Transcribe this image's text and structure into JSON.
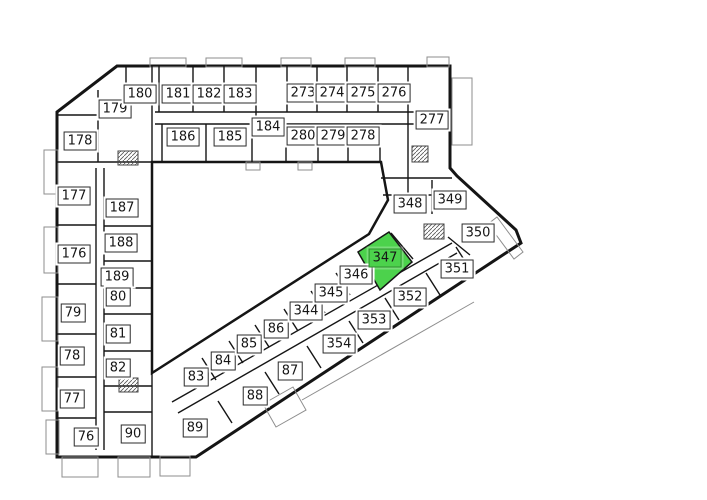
{
  "floorplan": {
    "selected_unit": "347",
    "highlight_fill": "#4cd24c",
    "highlight_border": "#2e8f2e",
    "wall_color": "#151515",
    "label_background": "#ffffff",
    "label_border": "#2b2b2b",
    "label_text_color": "#161616",
    "units": [
      {
        "number": "179",
        "x": 115,
        "y": 109,
        "highlighted": false
      },
      {
        "number": "180",
        "x": 140,
        "y": 94,
        "highlighted": false
      },
      {
        "number": "181",
        "x": 178,
        "y": 94,
        "highlighted": false
      },
      {
        "number": "182",
        "x": 209,
        "y": 94,
        "highlighted": false
      },
      {
        "number": "183",
        "x": 240,
        "y": 94,
        "highlighted": false
      },
      {
        "number": "178",
        "x": 80,
        "y": 141,
        "highlighted": false
      },
      {
        "number": "186",
        "x": 183,
        "y": 137,
        "highlighted": false
      },
      {
        "number": "185",
        "x": 230,
        "y": 137,
        "highlighted": false
      },
      {
        "number": "184",
        "x": 268,
        "y": 127,
        "highlighted": false
      },
      {
        "number": "187",
        "x": 122,
        "y": 208,
        "highlighted": false
      },
      {
        "number": "273",
        "x": 303,
        "y": 93,
        "highlighted": false
      },
      {
        "number": "274",
        "x": 332,
        "y": 93,
        "highlighted": false
      },
      {
        "number": "275",
        "x": 363,
        "y": 93,
        "highlighted": false
      },
      {
        "number": "276",
        "x": 394,
        "y": 93,
        "highlighted": false
      },
      {
        "number": "280",
        "x": 303,
        "y": 136,
        "highlighted": false
      },
      {
        "number": "279",
        "x": 333,
        "y": 136,
        "highlighted": false
      },
      {
        "number": "278",
        "x": 363,
        "y": 136,
        "highlighted": false
      },
      {
        "number": "277",
        "x": 432,
        "y": 120,
        "highlighted": false
      },
      {
        "number": "177",
        "x": 74,
        "y": 196,
        "highlighted": false
      },
      {
        "number": "176",
        "x": 74,
        "y": 254,
        "highlighted": false
      },
      {
        "number": "188",
        "x": 121,
        "y": 243,
        "highlighted": false
      },
      {
        "number": "189",
        "x": 117,
        "y": 277,
        "highlighted": false
      },
      {
        "number": "80",
        "x": 118,
        "y": 297,
        "highlighted": false
      },
      {
        "number": "79",
        "x": 73,
        "y": 313,
        "highlighted": false
      },
      {
        "number": "81",
        "x": 118,
        "y": 334,
        "highlighted": false
      },
      {
        "number": "78",
        "x": 72,
        "y": 356,
        "highlighted": false
      },
      {
        "number": "82",
        "x": 118,
        "y": 368,
        "highlighted": false
      },
      {
        "number": "77",
        "x": 72,
        "y": 399,
        "highlighted": false
      },
      {
        "number": "76",
        "x": 86,
        "y": 437,
        "highlighted": false
      },
      {
        "number": "90",
        "x": 133,
        "y": 434,
        "highlighted": false
      },
      {
        "number": "83",
        "x": 196,
        "y": 377,
        "highlighted": false
      },
      {
        "number": "84",
        "x": 223,
        "y": 361,
        "highlighted": false
      },
      {
        "number": "85",
        "x": 249,
        "y": 344,
        "highlighted": false
      },
      {
        "number": "86",
        "x": 276,
        "y": 329,
        "highlighted": false
      },
      {
        "number": "344",
        "x": 306,
        "y": 311,
        "highlighted": false
      },
      {
        "number": "345",
        "x": 331,
        "y": 293,
        "highlighted": false
      },
      {
        "number": "346",
        "x": 356,
        "y": 275,
        "highlighted": false
      },
      {
        "number": "347",
        "x": 385,
        "y": 258,
        "highlighted": true
      },
      {
        "number": "89",
        "x": 195,
        "y": 428,
        "highlighted": false
      },
      {
        "number": "88",
        "x": 255,
        "y": 396,
        "highlighted": false
      },
      {
        "number": "87",
        "x": 290,
        "y": 371,
        "highlighted": false
      },
      {
        "number": "354",
        "x": 339,
        "y": 344,
        "highlighted": false
      },
      {
        "number": "353",
        "x": 374,
        "y": 320,
        "highlighted": false
      },
      {
        "number": "352",
        "x": 410,
        "y": 297,
        "highlighted": false
      },
      {
        "number": "351",
        "x": 457,
        "y": 269,
        "highlighted": false
      },
      {
        "number": "350",
        "x": 478,
        "y": 233,
        "highlighted": false
      },
      {
        "number": "349",
        "x": 450,
        "y": 200,
        "highlighted": false
      },
      {
        "number": "348",
        "x": 410,
        "y": 204,
        "highlighted": false
      }
    ]
  }
}
